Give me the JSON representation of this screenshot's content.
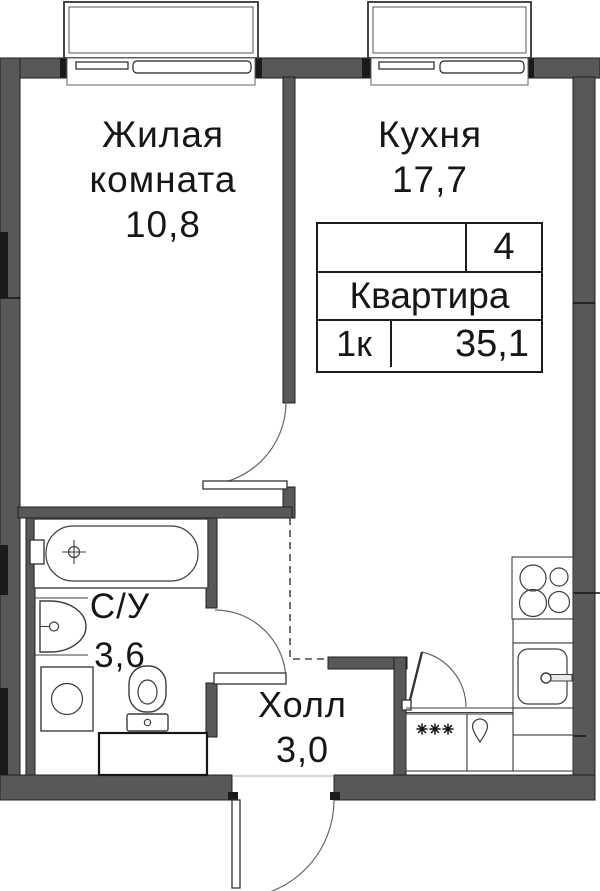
{
  "title": "Floor plan — 1-room apartment 35,1 m²",
  "rooms": {
    "living": {
      "line1": "Жилая",
      "line2": "комната",
      "area": "10,8"
    },
    "kitchen": {
      "name": "Кухня",
      "area": "17,7"
    },
    "bathroom": {
      "name": "С/У",
      "area": "3,6"
    },
    "hall": {
      "name": "Холл",
      "area": "3,0"
    }
  },
  "info_table": {
    "floor": "4",
    "label": "Квартира",
    "rooms_count": "1к",
    "total_area": "35,1"
  },
  "colors": {
    "wall": "#58585a",
    "accent_black": "#1a1a1a",
    "fixture_line": "#3d3d3d",
    "text": "#161616",
    "background": "#ffffff"
  },
  "fixtures": {
    "bathroom": [
      "bathtub-icon",
      "bath-sink-icon",
      "washing-machine-icon",
      "toilet-icon",
      "cabinet-icon"
    ],
    "kitchen": [
      "stove-icon",
      "kitchen-sink-icon",
      "fridge-snowflakes-icon",
      "water-drop-icon"
    ],
    "openings": [
      "window-icon",
      "door-arc-icon",
      "entrance-door-icon"
    ]
  }
}
